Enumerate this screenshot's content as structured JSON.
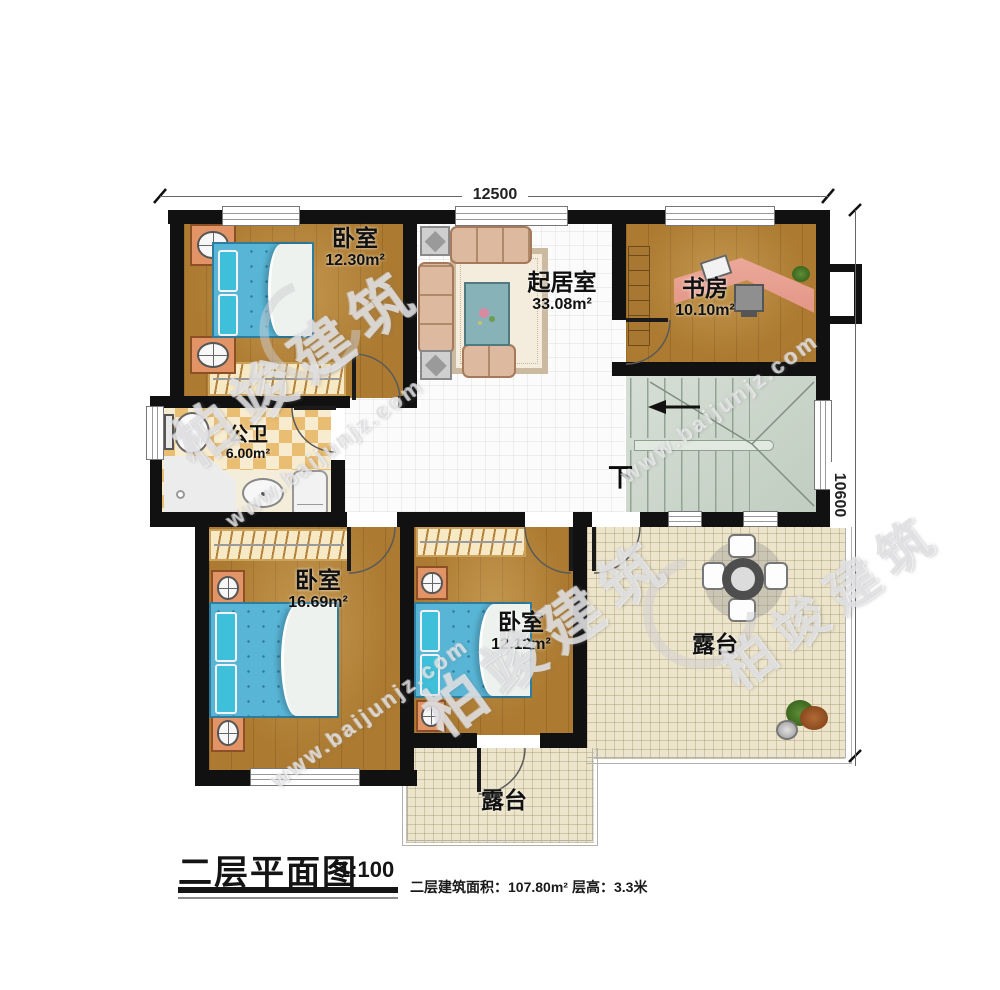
{
  "watermark": {
    "brand": "柏竣建筑",
    "url": "www.baijunjz.com"
  },
  "dimensions": {
    "top": "12500",
    "right": "10600"
  },
  "rooms": {
    "bedroom_nw": {
      "name": "卧室",
      "area": "12.30m²"
    },
    "living": {
      "name": "起居室",
      "area": "33.08m²"
    },
    "study": {
      "name": "书房",
      "area": "10.10m²"
    },
    "bathroom": {
      "name": "公卫",
      "area": "6.00m²"
    },
    "bedroom_sw": {
      "name": "卧室",
      "area": "16.69m²"
    },
    "bedroom_s": {
      "name": "卧室",
      "area": "12.12m²"
    },
    "terrace_east": {
      "name": "露台"
    },
    "terrace_south": {
      "name": "露台"
    }
  },
  "stairs": {
    "down": "下"
  },
  "titleblock": {
    "title": "二层平面图",
    "scale": "1:100",
    "area_label": "二层建筑面积：",
    "area_value": "107.80m²",
    "floor_height_label": "层高：",
    "floor_height_value": "3.3米"
  },
  "colors": {
    "wall": "#111111",
    "wood": "#ac7a31",
    "stairs": "#cdd7cc",
    "terrace": "#ece4cb",
    "bed": "#58b5d6"
  }
}
